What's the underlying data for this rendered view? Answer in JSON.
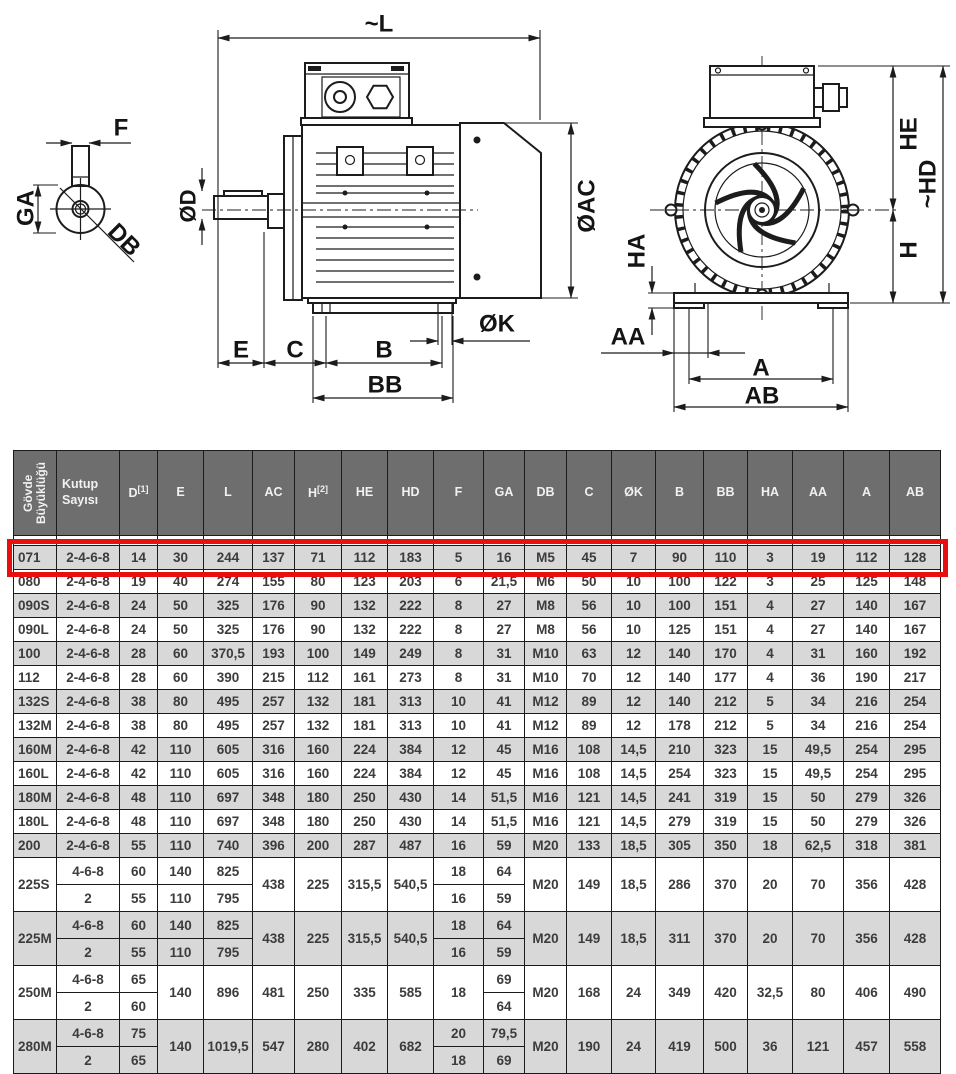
{
  "colors": {
    "highlight_red": "#e8100e",
    "header_bg": "#6f6e6f",
    "row_gray": "#d9d8d8",
    "line": "#1c1c1c",
    "cell_text": "#3d3b3c"
  },
  "diagram": {
    "labels": {
      "f": "F",
      "ga": "GA",
      "db": "DB",
      "l": "~L",
      "od": "ØD",
      "oac": "ØAC",
      "e": "E",
      "c": "C",
      "b": "B",
      "bb": "BB",
      "ok": "ØK",
      "he": "HE",
      "hd": "~HD",
      "h": "H",
      "ha": "HA",
      "aa": "AA",
      "a": "A",
      "ab": "AB"
    }
  },
  "table": {
    "columns": [
      {
        "label": "Gövde Büyüklüğü",
        "rotated": true
      },
      {
        "label": "Kutup Sayısı"
      },
      {
        "label": "D",
        "sup": "[1]"
      },
      {
        "label": "E"
      },
      {
        "label": "L"
      },
      {
        "label": "AC"
      },
      {
        "label": "H",
        "sup": "[2]"
      },
      {
        "label": "HE"
      },
      {
        "label": "HD"
      },
      {
        "label": "F"
      },
      {
        "label": "GA"
      },
      {
        "label": "DB"
      },
      {
        "label": "C"
      },
      {
        "label": "ØK"
      },
      {
        "label": "B"
      },
      {
        "label": "BB"
      },
      {
        "label": "HA"
      },
      {
        "label": "AA"
      },
      {
        "label": "A"
      },
      {
        "label": "AB"
      }
    ],
    "rows": [
      {
        "shade": "gray",
        "highlight": true,
        "cells": [
          "071",
          "2-4-6-8",
          "14",
          "30",
          "244",
          "137",
          "71",
          "112",
          "183",
          "5",
          "16",
          "M5",
          "45",
          "7",
          "90",
          "110",
          "3",
          "19",
          "112",
          "128"
        ]
      },
      {
        "shade": "white",
        "cells": [
          "080",
          "2-4-6-8",
          "19",
          "40",
          "274",
          "155",
          "80",
          "123",
          "203",
          "6",
          "21,5",
          "M6",
          "50",
          "10",
          "100",
          "122",
          "3",
          "25",
          "125",
          "148"
        ]
      },
      {
        "shade": "gray",
        "cells": [
          "090S",
          "2-4-6-8",
          "24",
          "50",
          "325",
          "176",
          "90",
          "132",
          "222",
          "8",
          "27",
          "M8",
          "56",
          "10",
          "100",
          "151",
          "4",
          "27",
          "140",
          "167"
        ]
      },
      {
        "shade": "white",
        "cells": [
          "090L",
          "2-4-6-8",
          "24",
          "50",
          "325",
          "176",
          "90",
          "132",
          "222",
          "8",
          "27",
          "M8",
          "56",
          "10",
          "125",
          "151",
          "4",
          "27",
          "140",
          "167"
        ]
      },
      {
        "shade": "gray",
        "cells": [
          "100",
          "2-4-6-8",
          "28",
          "60",
          "370,5",
          "193",
          "100",
          "149",
          "249",
          "8",
          "31",
          "M10",
          "63",
          "12",
          "140",
          "170",
          "4",
          "31",
          "160",
          "192"
        ]
      },
      {
        "shade": "white",
        "cells": [
          "112",
          "2-4-6-8",
          "28",
          "60",
          "390",
          "215",
          "112",
          "161",
          "273",
          "8",
          "31",
          "M10",
          "70",
          "12",
          "140",
          "177",
          "4",
          "36",
          "190",
          "217"
        ]
      },
      {
        "shade": "gray",
        "cells": [
          "132S",
          "2-4-6-8",
          "38",
          "80",
          "495",
          "257",
          "132",
          "181",
          "313",
          "10",
          "41",
          "M12",
          "89",
          "12",
          "140",
          "212",
          "5",
          "34",
          "216",
          "254"
        ]
      },
      {
        "shade": "white",
        "cells": [
          "132M",
          "2-4-6-8",
          "38",
          "80",
          "495",
          "257",
          "132",
          "181",
          "313",
          "10",
          "41",
          "M12",
          "89",
          "12",
          "178",
          "212",
          "5",
          "34",
          "216",
          "254"
        ]
      },
      {
        "shade": "gray",
        "cells": [
          "160M",
          "2-4-6-8",
          "42",
          "110",
          "605",
          "316",
          "160",
          "224",
          "384",
          "12",
          "45",
          "M16",
          "108",
          "14,5",
          "210",
          "323",
          "15",
          "49,5",
          "254",
          "295"
        ]
      },
      {
        "shade": "white",
        "cells": [
          "160L",
          "2-4-6-8",
          "42",
          "110",
          "605",
          "316",
          "160",
          "224",
          "384",
          "12",
          "45",
          "M16",
          "108",
          "14,5",
          "254",
          "323",
          "15",
          "49,5",
          "254",
          "295"
        ]
      },
      {
        "shade": "gray",
        "cells": [
          "180M",
          "2-4-6-8",
          "48",
          "110",
          "697",
          "348",
          "180",
          "250",
          "430",
          "14",
          "51,5",
          "M16",
          "121",
          "14,5",
          "241",
          "319",
          "15",
          "50",
          "279",
          "326"
        ]
      },
      {
        "shade": "white",
        "cells": [
          "180L",
          "2-4-6-8",
          "48",
          "110",
          "697",
          "348",
          "180",
          "250",
          "430",
          "14",
          "51,5",
          "M16",
          "121",
          "14,5",
          "279",
          "319",
          "15",
          "50",
          "279",
          "326"
        ]
      },
      {
        "shade": "gray",
        "cells": [
          "200",
          "2-4-6-8",
          "55",
          "110",
          "740",
          "396",
          "200",
          "287",
          "487",
          "16",
          "59",
          "M20",
          "133",
          "18,5",
          "305",
          "350",
          "18",
          "62,5",
          "318",
          "381"
        ]
      },
      {
        "shade": "white",
        "tall": true,
        "cells": [
          {
            "v": "225S",
            "rs": 2
          },
          "4-6-8",
          "60",
          "140",
          "825",
          {
            "v": "438",
            "rs": 2
          },
          {
            "v": "225",
            "rs": 2
          },
          {
            "v": "315,5",
            "rs": 2
          },
          {
            "v": "540,5",
            "rs": 2
          },
          "18",
          "64",
          {
            "v": "M20",
            "rs": 2
          },
          {
            "v": "149",
            "rs": 2
          },
          {
            "v": "18,5",
            "rs": 2
          },
          {
            "v": "286",
            "rs": 2
          },
          {
            "v": "370",
            "rs": 2
          },
          {
            "v": "20",
            "rs": 2
          },
          {
            "v": "70",
            "rs": 2
          },
          {
            "v": "356",
            "rs": 2
          },
          {
            "v": "428",
            "rs": 2
          }
        ]
      },
      {
        "shade": "white",
        "tall": true,
        "cells": [
          null,
          "2",
          "55",
          "110",
          "795",
          null,
          null,
          null,
          null,
          "16",
          "59",
          null,
          null,
          null,
          null,
          null,
          null,
          null,
          null,
          null
        ]
      },
      {
        "shade": "gray",
        "tall": true,
        "cells": [
          {
            "v": "225M",
            "rs": 2
          },
          "4-6-8",
          "60",
          "140",
          "825",
          {
            "v": "438",
            "rs": 2
          },
          {
            "v": "225",
            "rs": 2
          },
          {
            "v": "315,5",
            "rs": 2
          },
          {
            "v": "540,5",
            "rs": 2
          },
          "18",
          "64",
          {
            "v": "M20",
            "rs": 2
          },
          {
            "v": "149",
            "rs": 2
          },
          {
            "v": "18,5",
            "rs": 2
          },
          {
            "v": "311",
            "rs": 2
          },
          {
            "v": "370",
            "rs": 2
          },
          {
            "v": "20",
            "rs": 2
          },
          {
            "v": "70",
            "rs": 2
          },
          {
            "v": "356",
            "rs": 2
          },
          {
            "v": "428",
            "rs": 2
          }
        ]
      },
      {
        "shade": "gray",
        "tall": true,
        "cells": [
          null,
          "2",
          "55",
          "110",
          "795",
          null,
          null,
          null,
          null,
          "16",
          "59",
          null,
          null,
          null,
          null,
          null,
          null,
          null,
          null,
          null
        ]
      },
      {
        "shade": "white",
        "tall": true,
        "cells": [
          {
            "v": "250M",
            "rs": 2
          },
          "4-6-8",
          "65",
          {
            "v": "140",
            "rs": 2
          },
          {
            "v": "896",
            "rs": 2
          },
          {
            "v": "481",
            "rs": 2
          },
          {
            "v": "250",
            "rs": 2
          },
          {
            "v": "335",
            "rs": 2
          },
          {
            "v": "585",
            "rs": 2
          },
          {
            "v": "18",
            "rs": 2
          },
          "69",
          {
            "v": "M20",
            "rs": 2
          },
          {
            "v": "168",
            "rs": 2
          },
          {
            "v": "24",
            "rs": 2
          },
          {
            "v": "349",
            "rs": 2
          },
          {
            "v": "420",
            "rs": 2
          },
          {
            "v": "32,5",
            "rs": 2
          },
          {
            "v": "80",
            "rs": 2
          },
          {
            "v": "406",
            "rs": 2
          },
          {
            "v": "490",
            "rs": 2
          }
        ]
      },
      {
        "shade": "white",
        "tall": true,
        "cells": [
          null,
          "2",
          "60",
          null,
          null,
          null,
          null,
          null,
          null,
          null,
          "64",
          null,
          null,
          null,
          null,
          null,
          null,
          null,
          null,
          null
        ]
      },
      {
        "shade": "gray",
        "tall": true,
        "cells": [
          {
            "v": "280M",
            "rs": 2
          },
          "4-6-8",
          "75",
          {
            "v": "140",
            "rs": 2
          },
          {
            "v": "1019,5",
            "rs": 2
          },
          {
            "v": "547",
            "rs": 2
          },
          {
            "v": "280",
            "rs": 2
          },
          {
            "v": "402",
            "rs": 2
          },
          {
            "v": "682",
            "rs": 2
          },
          "20",
          "79,5",
          {
            "v": "M20",
            "rs": 2
          },
          {
            "v": "190",
            "rs": 2
          },
          {
            "v": "24",
            "rs": 2
          },
          {
            "v": "419",
            "rs": 2
          },
          {
            "v": "500",
            "rs": 2
          },
          {
            "v": "36",
            "rs": 2
          },
          {
            "v": "121",
            "rs": 2
          },
          {
            "v": "457",
            "rs": 2
          },
          {
            "v": "558",
            "rs": 2
          }
        ]
      },
      {
        "shade": "gray",
        "tall": true,
        "cells": [
          null,
          "2",
          "65",
          null,
          null,
          null,
          null,
          null,
          null,
          "18",
          "69",
          null,
          null,
          null,
          null,
          null,
          null,
          null,
          null,
          null
        ]
      }
    ]
  }
}
